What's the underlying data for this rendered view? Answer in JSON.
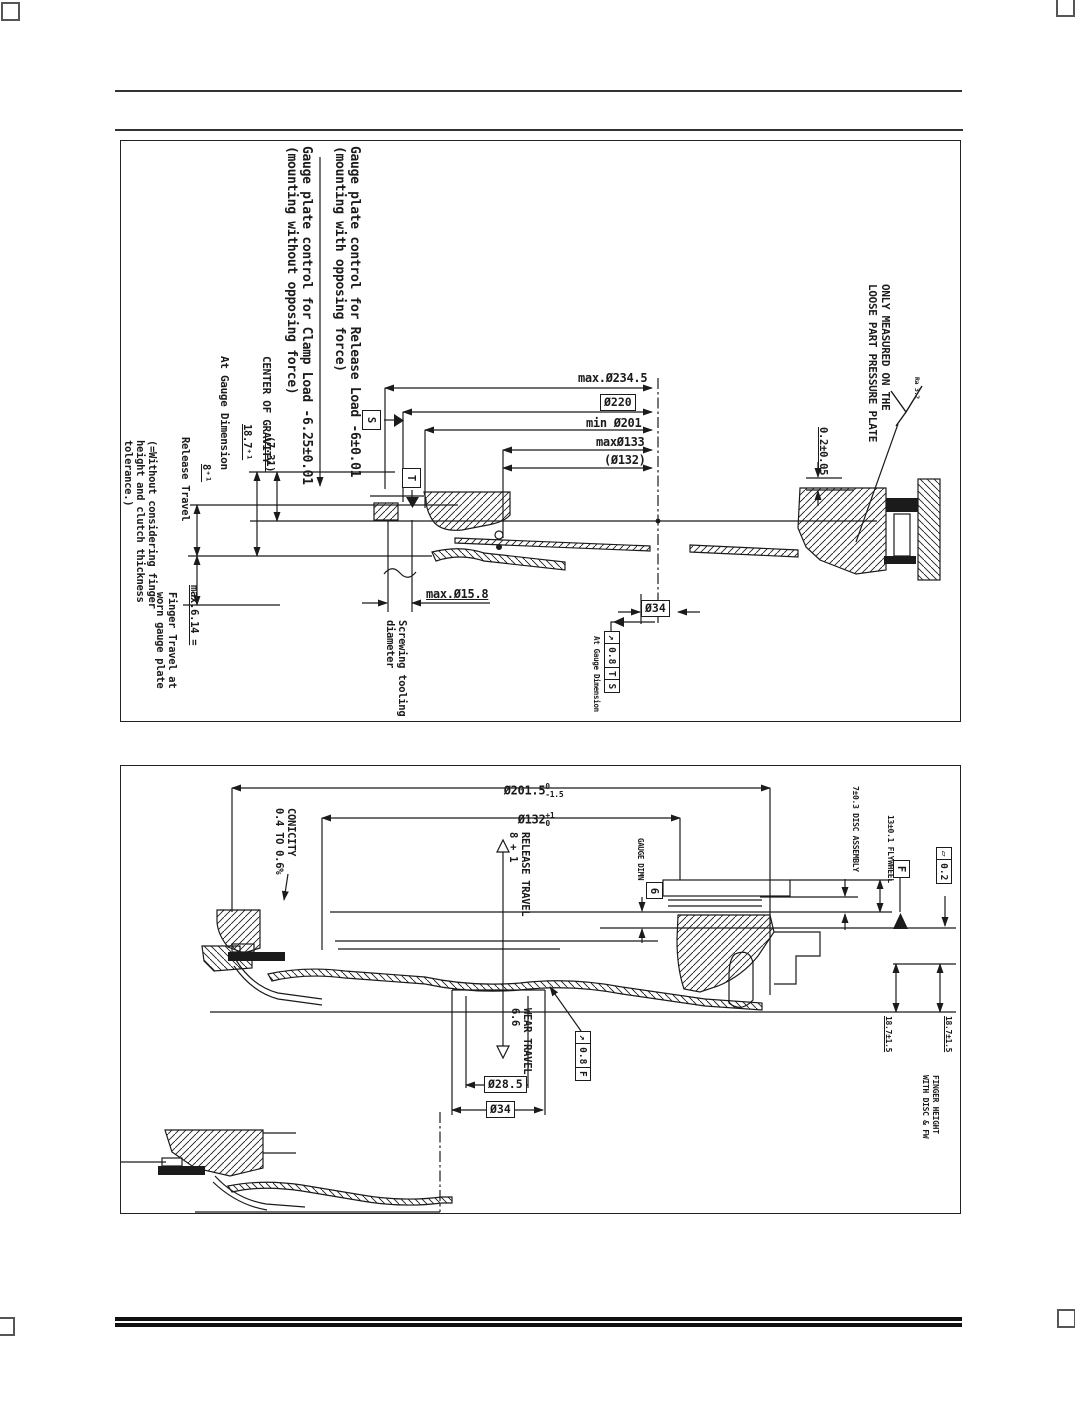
{
  "top": {
    "note_release": "Gauge plate control for Release Load -6±0.01\n(mounting with opposing force)",
    "note_clamp": "Gauge plate control for Clamp Load -6.25±0.01\n(mounting without opposing force)",
    "center_of_gravity": "CENTER OF GRAVITY",
    "cog_value": "(7.31)",
    "at_gauge_dimension": "At Gauge Dimension",
    "gauge_height": "18.7⁺¹",
    "release_travel": "Release Travel",
    "release_value": "8⁺¹",
    "finger_note": "(=Without considering finger\nheight and clutch thickness\ntolerance.)",
    "finger_max": "max.6.14 =",
    "finger_travel": "Finger Travel at\nworn gauge plate",
    "dia_234": "max.Ø234.5",
    "dia_220": "Ø220",
    "dia_201": "min Ø201",
    "dia_133": "maxØ133",
    "dia_132": "(Ø132)",
    "dia_15_8": "max.Ø15.8",
    "screwing": "Screwing tooling\ndiameter",
    "dia_34": "Ø34",
    "fcf": {
      "sym": "↗",
      "tol": "0.8",
      "d1": "T",
      "d2": "S"
    },
    "fcf_note": "At Gauge Dimension",
    "datum_s": "S",
    "datum_t": "T",
    "step_tol": "0.2±0.05",
    "roughness": "Ra 3.2",
    "only_measured": "ONLY MEASURED ON THE\nLOOSE PART PRESSURE PLATE"
  },
  "bottom": {
    "dia_201_5": {
      "v": "Ø201.5",
      "hi": "0",
      "lo": "-1.5"
    },
    "dia_132": {
      "v": "Ø132",
      "hi": "+1",
      "lo": "0"
    },
    "conicity": "CONICITY\n0.4 TO 0.6%",
    "release_travel": "RELEASE TRAVEL\n8 + 1",
    "wear_travel": "WEAR TRAVEL\n6.6",
    "gauge_dimn": "GAUGE DIMN",
    "gauge_value": "6",
    "disc_assembly": "7±0.3 DISC ASSEMBLY",
    "flywheel": "13±0.1 FLYWHEEL",
    "datum_f": "F",
    "flatness": {
      "sym": "▱",
      "tol": "0.2"
    },
    "fcf": {
      "sym": "↗",
      "tol": "0.8",
      "d1": "F"
    },
    "height_a": "18.7±1.5",
    "height_b": "18.7±1.5",
    "finger_height": "FINGER HEIGHT\nWITH DISC & FW",
    "dia_28_5": "Ø28.5",
    "dia_34": "Ø34"
  }
}
